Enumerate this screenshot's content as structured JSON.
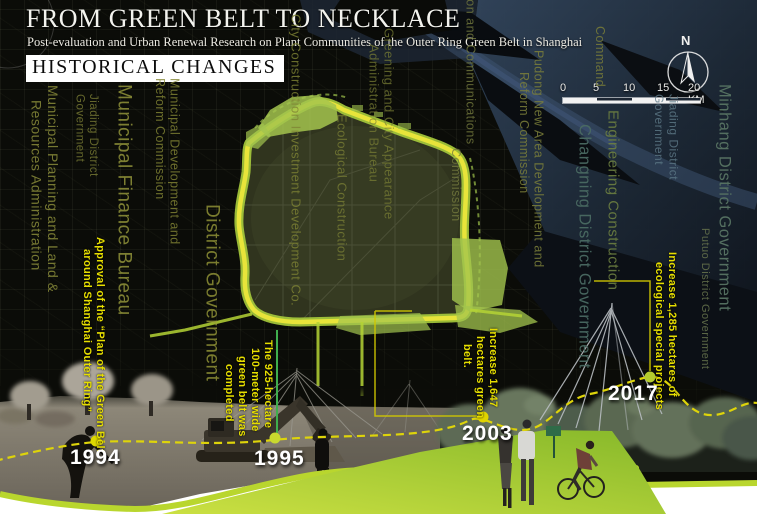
{
  "header": {
    "title": "FROM GREEN BELT TO NECKLACE",
    "subtitle": "Post-evaluation and Urban Renewal Research on Plant Communities of the Outer Ring Green Belt in Shanghai",
    "section": "HISTORICAL CHANGES"
  },
  "map": {
    "north_label": "N",
    "scale": {
      "t0": "0",
      "t1": "5",
      "t2": "10",
      "t3": "15",
      "end": "20 KM"
    },
    "gov_labels": [
      {
        "id": "municipal-planning-land",
        "lines": [
          "Municipal Planning and Land &",
          "Resources Administration"
        ]
      },
      {
        "id": "jiading-district-gov-left",
        "lines": [
          "Jiading District",
          "Government"
        ]
      },
      {
        "id": "municipal-finance-bureau",
        "lines": [
          "Municipal Finance Bureau"
        ]
      },
      {
        "id": "municipal-dev-reform",
        "lines": [
          "Municipal Development and",
          "Reform Commission"
        ]
      },
      {
        "id": "district-government",
        "lines": [
          "District Government"
        ]
      },
      {
        "id": "city-construction-investment",
        "lines": [
          "City Construction Investment Development Co."
        ]
      },
      {
        "id": "ecological-construction",
        "lines": [
          "Ecological Construction"
        ]
      },
      {
        "id": "greening-city-appearance",
        "lines": [
          "Greening and City Appearance",
          "Administration Bureau"
        ]
      },
      {
        "id": "construction-communications",
        "lines": [
          "Construction and Communications",
          "Commission"
        ]
      },
      {
        "id": "pudong-new-area",
        "lines": [
          "Pudong New Area Development and",
          "Reform Commission"
        ]
      },
      {
        "id": "command",
        "lines": [
          "Command"
        ]
      },
      {
        "id": "changning-district-gov",
        "lines": [
          "Changning District Government"
        ]
      },
      {
        "id": "engineering-construction",
        "lines": [
          "Engineering Construction"
        ]
      },
      {
        "id": "jiading-district-gov-right",
        "lines": [
          "Jiading District",
          "Government"
        ]
      },
      {
        "id": "minhang-district-gov",
        "lines": [
          "Minhang District Government"
        ]
      },
      {
        "id": "putuo-district-gov",
        "lines": [
          "Putuo District Government"
        ]
      }
    ]
  },
  "timeline": {
    "events": [
      {
        "year": "1994",
        "note_lines": [
          "Approval of the “Plan of the Green Belt",
          "around Shanghai Outer Ring”"
        ]
      },
      {
        "year": "1995",
        "note_lines": [
          "The 925-hectare",
          "100-meter wide",
          "green belt was",
          "completed"
        ]
      },
      {
        "year": "2003",
        "note_lines": [
          "Increase 1,647",
          "hectares green",
          "belt."
        ]
      },
      {
        "year": "2017",
        "note_lines": [
          "Increase 1,285 hectares of",
          "ecological special projects"
        ]
      }
    ]
  },
  "colors": {
    "ring_yellow": "#e8e43a",
    "ring_green": "#a8cc3c",
    "annotation_yellow": "#e6de00",
    "timeline_dash": "#ded40a",
    "lime_border": "#b9d62e",
    "water_blue": "#2e3f55",
    "label_olive": "#8a8c3a"
  }
}
